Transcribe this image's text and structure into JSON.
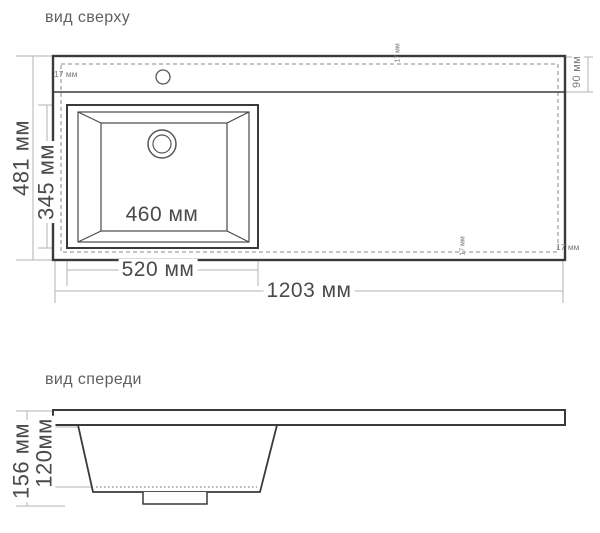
{
  "colors": {
    "line_dark": "#3a3a3a",
    "line_mid": "#555555",
    "line_dim": "#b3b3b3",
    "dash": "#8a8a8a",
    "text_dark": "#4a4a4a",
    "text_small": "#7a7a7a",
    "title_text": "#5f5f5f",
    "background": "#ffffff"
  },
  "top_view": {
    "title": "вид сверху",
    "labels": {
      "overall_width": "1203 мм",
      "bowl_width": "520 мм",
      "bowl_inner_width": "460 мм",
      "overall_depth": "481 мм",
      "bowl_depth": "345 мм",
      "deck_width": "90 мм",
      "rim_offset_top_left": "17 мм",
      "rim_offset_top": "17 мм",
      "rim_offset_bottom": "17 мм",
      "rim_offset_bottom_right": "17 мм"
    }
  },
  "front_view": {
    "title": "вид спереди",
    "labels": {
      "total_height": "156 мм",
      "basin_height": "120мм"
    }
  }
}
